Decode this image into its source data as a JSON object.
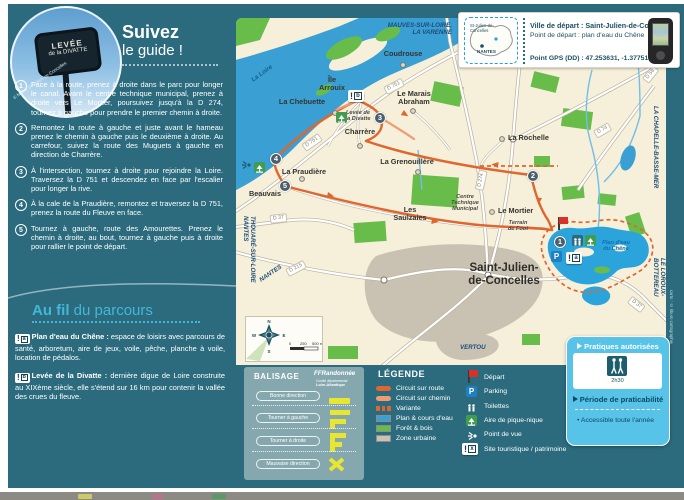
{
  "icons": {
    "exclamation": "!",
    "parking": "P",
    "bullet": "•"
  },
  "sidebar": {
    "photo_sign_line1": "LEVÉE",
    "photo_sign_line2": "de la DIVATTE",
    "photo_credit": "© Mairie St-Julien-de-Concelles",
    "title_bold": "Suivez",
    "title_rest": "le guide !",
    "steps": [
      {
        "num": "1",
        "text": "Face à la route, prenez à droite dans le parc pour longer le canal. Avant le centre technique municipal, prenez à droite vers Le Mortier, poursuivez jusqu'à la D 274, tournez à gauche pour prendre le premier chemin à droite."
      },
      {
        "num": "2",
        "text": "Remontez la route à gauche et juste avant le hameau prenez le chemin à gauche puis le deuxième à droite. Au carrefour, suivez la route des Muguets à gauche en direction de Charrère."
      },
      {
        "num": "3",
        "text": "À l'intersection, tournez à droite pour rejoindre la Loire. Traversez la D 751 et descendez en face par l'escalier pour longer la rive."
      },
      {
        "num": "4",
        "text": "À la cale de la Praudière, remontez et traversez la D 751, prenez la route du Fleuve en face."
      },
      {
        "num": "5",
        "text": "Tournez à gauche, route des Amourettes. Prenez le chemin à droite, au bout, tournez à gauche puis à droite pour rallier le point de départ."
      }
    ],
    "aufil_bold": "Au fil",
    "aufil_rest": " du parcours",
    "aufil_items": [
      {
        "letter": "a",
        "name": "Plan d'eau du Chêne :",
        "text": " espace de loisirs avec parcours de santé, arboretum, aire de jeux, voile, pêche, planche à voile, location de pédalos."
      },
      {
        "letter": "b",
        "name": "Levée de la Divatte :",
        "text": " dernière digue de Loire construite au XIXème siècle, elle s'étend sur 16 km pour contenir la vallée des crues du fleuve."
      }
    ]
  },
  "infobox": {
    "minimap_city": "St-Julien-de-\nConcelles",
    "minimap_metro": "NANTES",
    "line1": "Ville de départ : Saint-Julien-de-Concelles",
    "line2": "Point de départ : plan d'eau du Chêne",
    "line3": "Point GPS (DD) : 47.253631, -1.377518"
  },
  "map": {
    "labels": {
      "mauves": "MAUVES-SUR-LOIRE,\nLA VARENNE",
      "coudrouse": "Coudrouse",
      "arrouix": "Île\nArrouix",
      "chebuette": "La Chebuette",
      "marais": "Le Marais\nAbraham",
      "levee": "Levée de\nla Divatte",
      "charrere": "Charrère",
      "rochelle": "La Rochelle",
      "grenouillere": "La Grenouillère",
      "praudiere": "La Praudière",
      "beauvais": "Beauvais",
      "saulzaies": "Les\nSaulzaies",
      "centre": "Centre\nTechnique\nMunicipal",
      "mortier": "Le Mortier",
      "terrain": "Terrain\nde Foot",
      "ville": "Saint-Julien-\nde-Concelles",
      "plandeau": "Plan d'eau\ndu Chêne",
      "loire": "La Loire",
      "chapelle": "LA CHAPELLE-BASSE-MER",
      "loroux": "LE LOROUX-BOTTEREAU",
      "vertou": "VERTOU",
      "thouare": "THOUARÉ-SUR-LOIRE\nNANTES",
      "nantes": "NANTES"
    },
    "roads": {
      "d751a": "D 751",
      "d751b": "D 751",
      "d274": "D 274",
      "d37a": "D 37",
      "d37b": "D 37",
      "d215": "D 215",
      "d58": "D 58",
      "d74": "D 74"
    },
    "markers": {
      "m1": "1",
      "m2": "2",
      "m3": "3",
      "m4": "4",
      "m5": "5",
      "a": "a",
      "b": "b"
    },
    "compass": {
      "n": "N",
      "s": "S",
      "e": "E",
      "w": "W"
    },
    "scale": {
      "zero": "0",
      "mid": "250",
      "end": "500 m"
    }
  },
  "balisage": {
    "title": "BALISAGE",
    "logo_name": "FFRandonnée",
    "logo_sub1": "Comité départemental",
    "logo_sub2": "Loire-Atlantique",
    "rows": [
      {
        "label": "Bonne direction"
      },
      {
        "label": "Tourner à gauche"
      },
      {
        "label": "Tourner à droite"
      },
      {
        "label": "Mauvaise direction"
      }
    ]
  },
  "legend": {
    "title": "LÉGENDE",
    "site_letter": "x",
    "lines": [
      {
        "label": "Circuit sur route"
      },
      {
        "label": "Circuit sur chemin"
      },
      {
        "label": "Variante"
      },
      {
        "label": "Plan & cours d'eau"
      },
      {
        "label": "Forêt & bois"
      },
      {
        "label": "Zone urbaine"
      }
    ],
    "pois": [
      {
        "label": "Départ"
      },
      {
        "label": "Parking"
      },
      {
        "label": "Toilettes"
      },
      {
        "label": "Aire de pique-nique"
      },
      {
        "label": "Point de vue"
      },
      {
        "label": "Site touristique / patrimoine"
      }
    ]
  },
  "panel": {
    "practices_title": "Pratiques autorisées",
    "duration": "2h30",
    "period_title": "Période de praticabilité",
    "period_item": "Accessible toute l'année"
  },
  "credit": "carto : © tiburo cartographie",
  "colors": {
    "teal": "#2b6b7d",
    "cyan": "#41b8da",
    "panel_blue": "#57c3e9",
    "orange": "#e0662f",
    "water": "#3a9fd3",
    "green": "#68bd4a",
    "urban": "#c9c2b2",
    "cream": "#f6efd9"
  }
}
